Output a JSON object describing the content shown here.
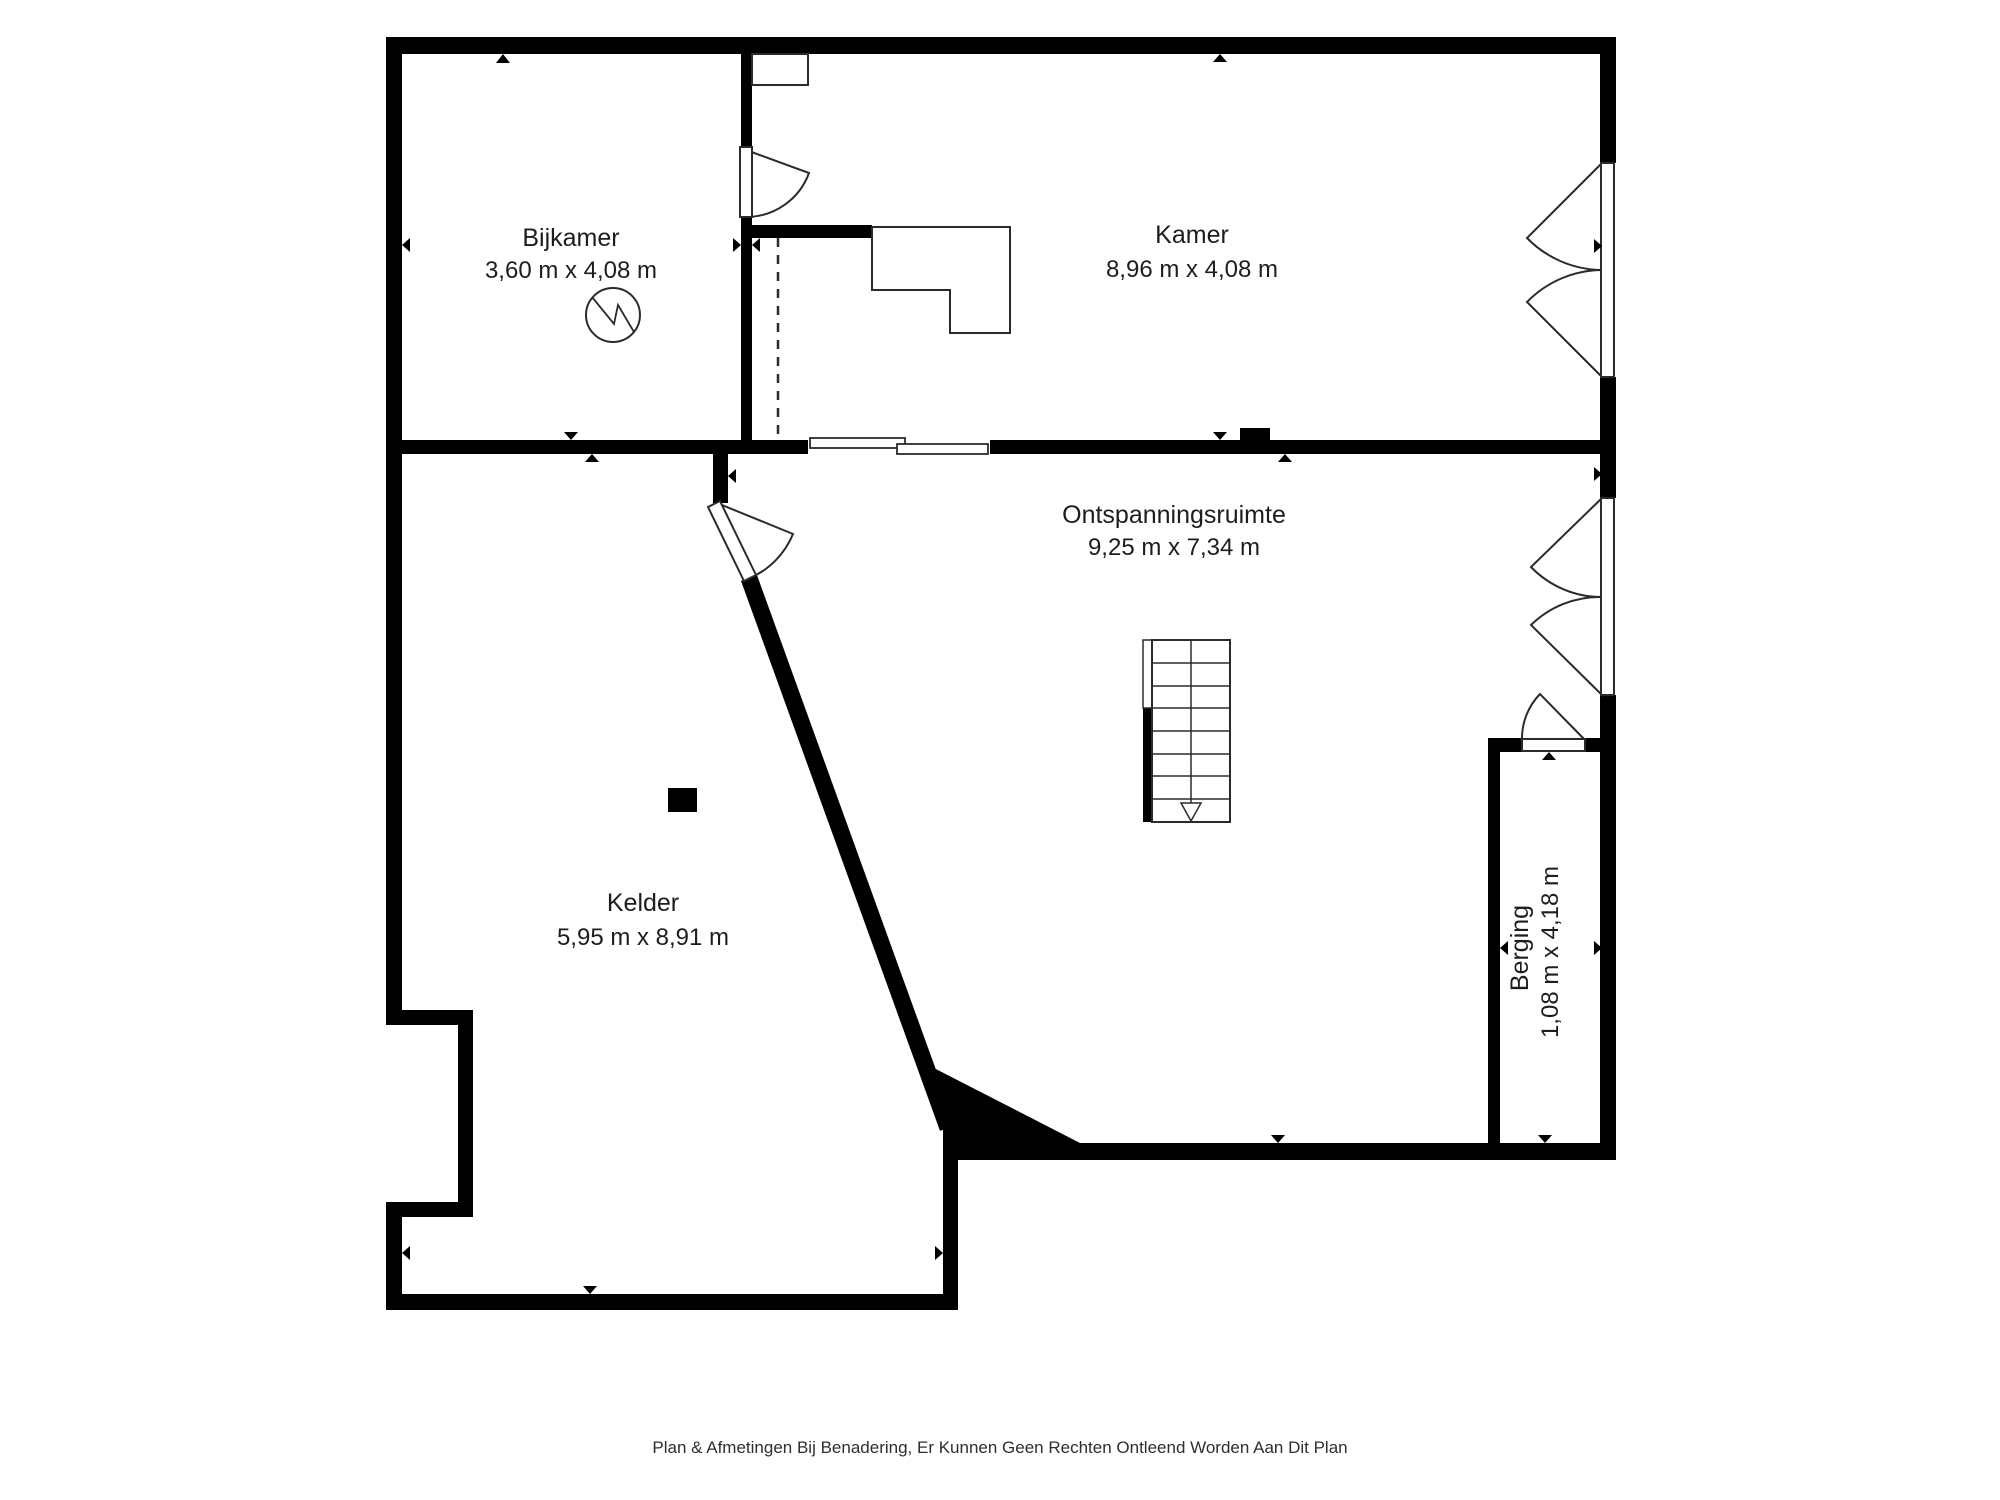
{
  "floorplan": {
    "footer": "Plan & Afmetingen Bij Benadering, Er Kunnen Geen Rechten Ontleend Worden Aan Dit Plan",
    "rooms": [
      {
        "name": "Bijkamer",
        "dimensions": "3,60 m x 4,08 m"
      },
      {
        "name": "Kamer",
        "dimensions": "8,96 m x 4,08 m"
      },
      {
        "name": "Ontspanningsruimte",
        "dimensions": "9,25 m x 7,34 m"
      },
      {
        "name": "Kelder",
        "dimensions": "5,95 m x 8,91 m"
      },
      {
        "name": "Berging",
        "dimensions": "1,08 m x 4,18 m"
      }
    ],
    "colors": {
      "wall": "#000000",
      "text": "#1d1d1d",
      "outline": "#2b2b2b",
      "background": "#ffffff"
    }
  }
}
